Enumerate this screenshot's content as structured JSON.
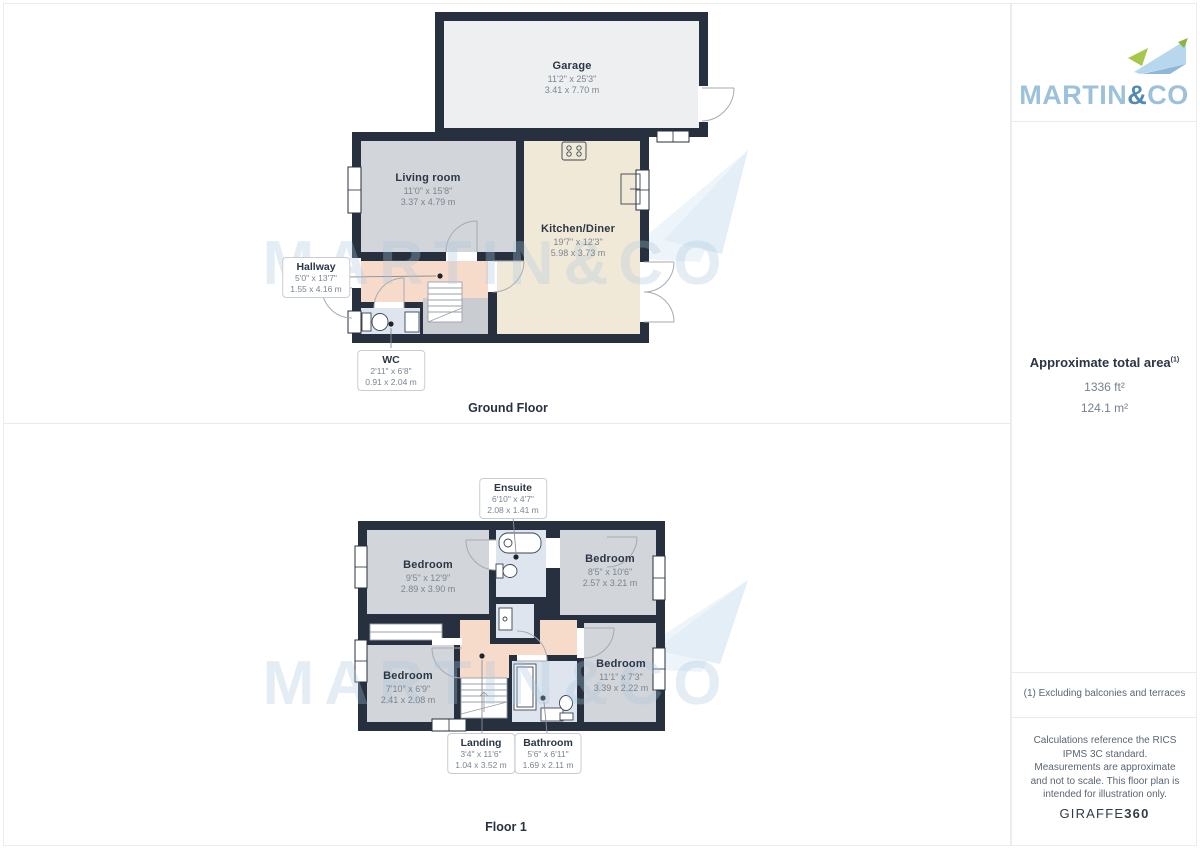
{
  "watermark": {
    "text": "MARTIN&CO"
  },
  "floors": [
    {
      "name": "Ground Floor",
      "rooms": [
        {
          "key": "garage",
          "label": "Garage",
          "imperial": "11'2\" x 25'3\"",
          "metric": "3.41 x 7.70 m"
        },
        {
          "key": "living-room",
          "label": "Living room",
          "imperial": "11'0\" x 15'8\"",
          "metric": "3.37 x 4.79 m"
        },
        {
          "key": "kitchen-diner",
          "label": "Kitchen/Diner",
          "imperial": "19'7\" x 12'3\"",
          "metric": "5.98 x 3.73 m"
        },
        {
          "key": "hallway",
          "label": "Hallway",
          "imperial": "5'0\" x 13'7\"",
          "metric": "1.55 x 4.16 m"
        },
        {
          "key": "wc",
          "label": "WC",
          "imperial": "2'11\" x 6'8\"",
          "metric": "0.91 x 2.04 m"
        }
      ]
    },
    {
      "name": "Floor 1",
      "rooms": [
        {
          "key": "bedroom-1",
          "label": "Bedroom",
          "imperial": "9'5\" x 12'9\"",
          "metric": "2.89 x 3.90 m"
        },
        {
          "key": "ensuite",
          "label": "Ensuite",
          "imperial": "6'10\" x 4'7\"",
          "metric": "2.08 x 1.41 m"
        },
        {
          "key": "bedroom-2",
          "label": "Bedroom",
          "imperial": "8'5\" x 10'6\"",
          "metric": "2.57 x 3.21 m"
        },
        {
          "key": "bedroom-3",
          "label": "Bedroom",
          "imperial": "7'10\" x 6'9\"",
          "metric": "2.41 x 2.08 m"
        },
        {
          "key": "landing",
          "label": "Landing",
          "imperial": "3'4\" x 11'6\"",
          "metric": "1.04 x 3.52 m"
        },
        {
          "key": "bathroom",
          "label": "Bathroom",
          "imperial": "5'6\" x 6'11\"",
          "metric": "1.69 x 2.11 m"
        },
        {
          "key": "bedroom-4",
          "label": "Bedroom",
          "imperial": "11'1\" x 7'3\"",
          "metric": "3.39 x 2.22 m"
        }
      ]
    }
  ],
  "sidebar": {
    "brand": {
      "part1": "MARTIN",
      "amp": "&",
      "part2": "CO"
    },
    "area": {
      "title": "Approximate total area",
      "sup": "(1)",
      "sqft": "1336 ft²",
      "sqm": "124.1 m²"
    },
    "footnote": "(1) Excluding balconies and terraces",
    "disclaimer": "Calculations reference the RICS IPMS 3C standard. Measurements are approximate and not to scale. This floor plan is intended for illustration only.",
    "credit": {
      "name": "GIRAFFE",
      "suffix": "360"
    }
  },
  "colors": {
    "wall": "#26303e",
    "garage_fill": "#edeff1",
    "room_fill": "#d2d5d9",
    "kitchen_fill": "#f1e9d7",
    "hall_fill": "#f7dbca",
    "wet_fill": "#dfe5ef",
    "under_stairs_fill": "#c9ccd0",
    "brand_blue": "#9cc1db",
    "brand_dark_blue": "#5188b4",
    "brand_green": "#9cc23d",
    "watermark_blue": "#a9c7de"
  }
}
